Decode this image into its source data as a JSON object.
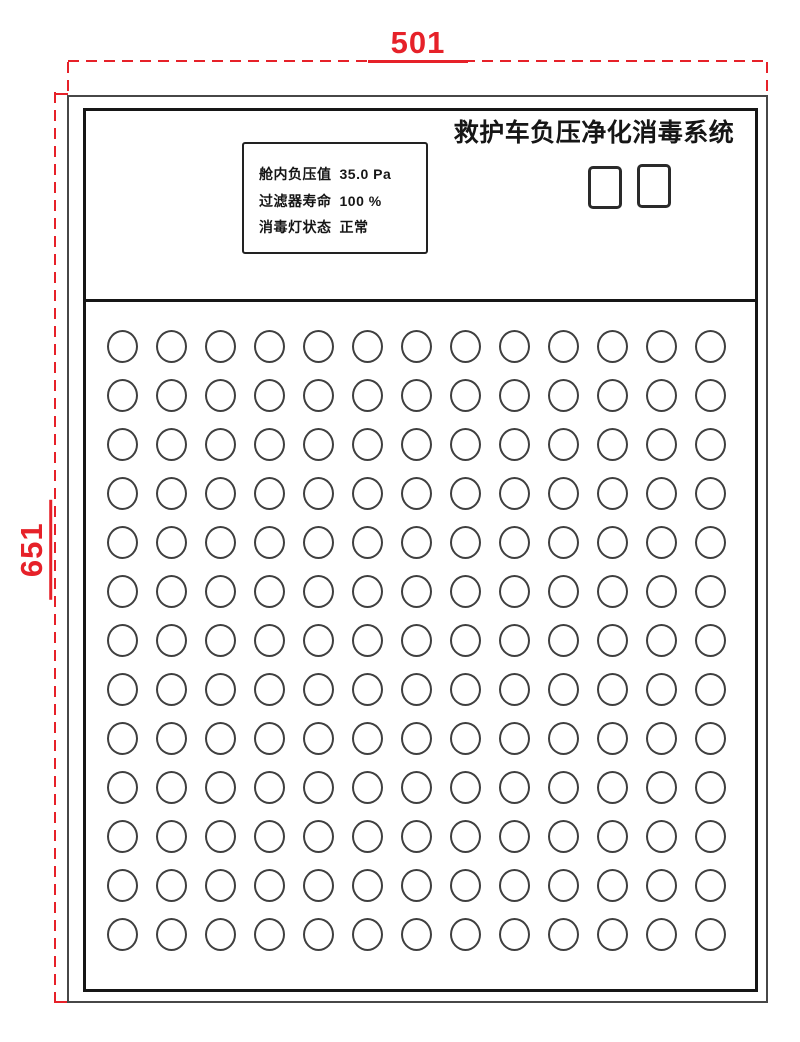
{
  "title": "救护车负压净化消毒系统",
  "dimensions": {
    "width_label": "501",
    "height_label": "651"
  },
  "display_panel": {
    "lines": [
      {
        "label": "舱内负压值",
        "value": "35.0 Pa"
      },
      {
        "label": "过滤器寿命",
        "value": "100 %"
      },
      {
        "label": "消毒灯状态",
        "value": "正常"
      }
    ]
  },
  "controls": {
    "button_count": 2
  },
  "vent_grid": {
    "rows": 13,
    "cols": 13
  },
  "colors": {
    "dimension_red": "#e62129",
    "line_black": "#161616"
  }
}
